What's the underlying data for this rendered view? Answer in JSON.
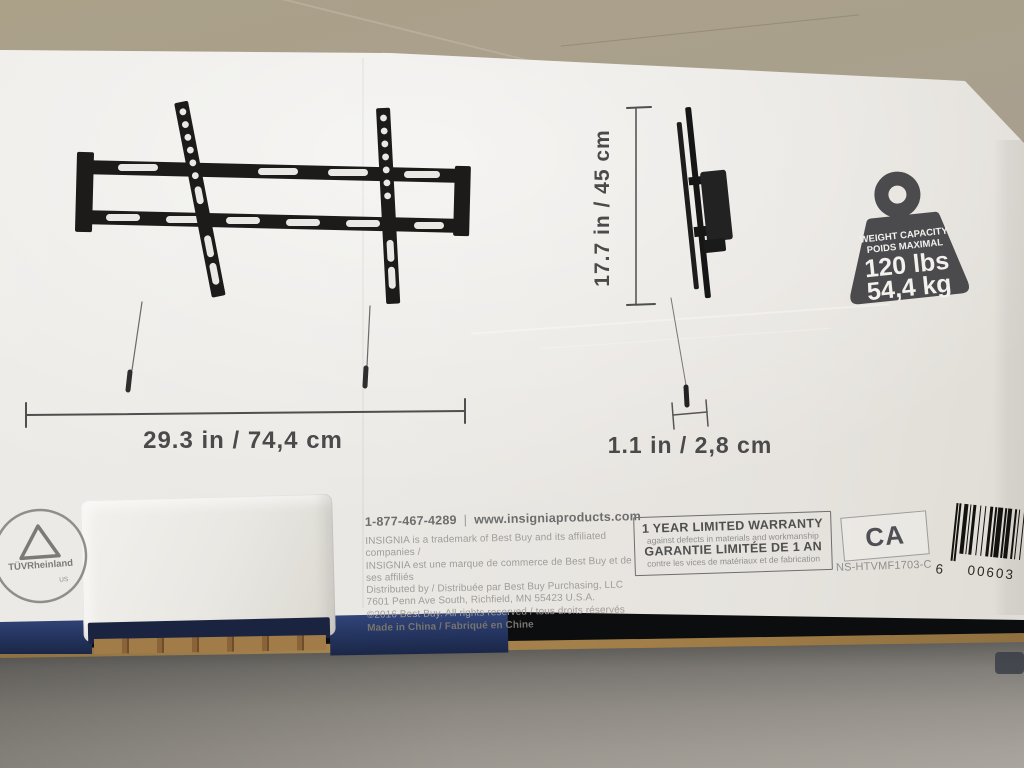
{
  "product_box": {
    "front_view": {
      "width_label": "29.3 in / 74,4 cm"
    },
    "side_view": {
      "height_label": "17.7 in / 45 cm",
      "depth_label": "1.1 in / 2,8 cm"
    },
    "weight_badge": {
      "title_en": "WEIGHT CAPACITY",
      "title_fr": "POIDS MAXIMAL",
      "capacity_lbs": "120 lbs",
      "capacity_kg": "54,4 kg"
    },
    "contact": {
      "phone": "1-877-467-4289",
      "website": "www.insigniaproducts.com"
    },
    "legal_lines": [
      "INSIGNIA is a trademark of Best Buy and its affiliated companies /",
      "INSIGNIA est une marque de commerce de Best Buy et de ses affiliés",
      "Distributed by / Distribuée par Best Buy Purchasing, LLC",
      "7601 Penn Ave South, Richfield, MN 55423 U.S.A.",
      "©2016 Best Buy. All rights reserved / tous droits réservés",
      "Made in China / Fabriqué en Chine"
    ],
    "warranty": {
      "en_title": "1 YEAR LIMITED WARRANTY",
      "en_sub": "against defects in materials and workmanship",
      "fr_title": "GARANTIE LIMITÉE DE 1 AN",
      "fr_sub": "contre les vices de matériaux et de fabrication"
    },
    "certification": {
      "ca": "CA",
      "model": "NS-HTVMF1703-C",
      "tuv": "TÜVRheinland",
      "tuv_sub": "US"
    },
    "barcode": {
      "lead_digit": "6",
      "digits": "00603",
      "bars": [
        1,
        1,
        1,
        2,
        2,
        1,
        1,
        1,
        2,
        2,
        1,
        2,
        1,
        2,
        2,
        1,
        1,
        1,
        3,
        1,
        1,
        1,
        2,
        2,
        1,
        1,
        1,
        2,
        1,
        2,
        2,
        1,
        1,
        1,
        3,
        1
      ]
    }
  },
  "colors": {
    "box_face": "#eae8e4",
    "graphic_dark": "#1c1b1a",
    "dim_line": "#4f4f4f",
    "dim_text": "#4a4a4a",
    "badge_gray": "#4b4b4e",
    "navy_edge": "#24345f",
    "cardboard": "#a8854f",
    "barcode_ink": "#14120f",
    "table_top": "#a89f8e",
    "table_shadow": "#6b6965"
  }
}
